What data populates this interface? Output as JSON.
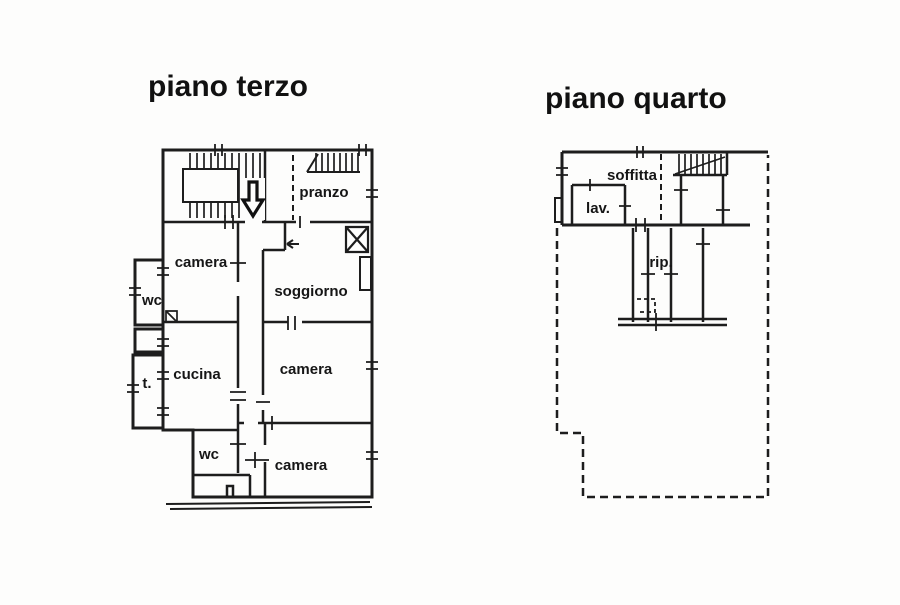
{
  "document": {
    "type": "floor-plan-drawing",
    "background_color": "#fdfdfc",
    "ink_color": "#1d1d1d"
  },
  "floor_plans": [
    {
      "title": "piano terzo",
      "rooms": [
        {
          "label": "pranzo"
        },
        {
          "label": "camera"
        },
        {
          "label": "wc"
        },
        {
          "label": "soggiorno"
        },
        {
          "label": "cucina"
        },
        {
          "label": "t."
        },
        {
          "label": "camera"
        },
        {
          "label": "wc"
        },
        {
          "label": "camera"
        }
      ],
      "icons": [
        {
          "name": "stair-down-arrow",
          "glyph": "⇩"
        },
        {
          "name": "entry-arrow",
          "glyph": "←"
        },
        {
          "name": "flue-shaft",
          "glyph": "⊠"
        }
      ]
    },
    {
      "title": "piano quarto",
      "rooms": [
        {
          "label": "soffitta"
        },
        {
          "label": "lav."
        },
        {
          "label": "rip."
        }
      ],
      "icons": []
    }
  ]
}
